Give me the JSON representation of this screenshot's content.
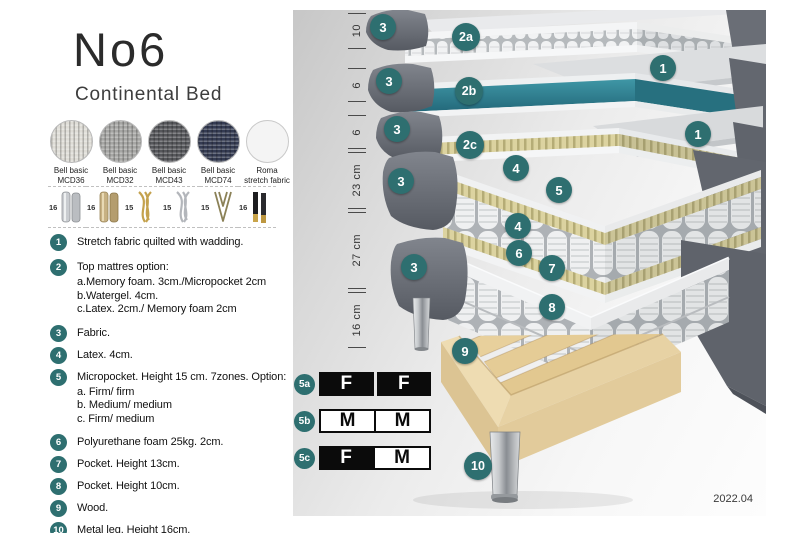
{
  "header": {
    "title": "No6",
    "subtitle": "Continental Bed"
  },
  "fabric_swatches": [
    {
      "name": "Bell basic",
      "code": "MCD36",
      "color": "#dedcd6"
    },
    {
      "name": "Bell basic",
      "code": "MCD32",
      "color": "#a6a6a4"
    },
    {
      "name": "Bell basic",
      "code": "MCD43",
      "color": "#56575b"
    },
    {
      "name": "Bell basic",
      "code": "MCD74",
      "color": "#343b52"
    },
    {
      "name": "Roma",
      "code": "stretch fabric",
      "color": "#f4f4f4"
    }
  ],
  "legs": [
    {
      "height": "16",
      "type": "cylinder-silver"
    },
    {
      "height": "16",
      "type": "cylinder-brass"
    },
    {
      "height": "15",
      "type": "twisted-gold"
    },
    {
      "height": "15",
      "type": "twisted-silver"
    },
    {
      "height": "15",
      "type": "hairpin"
    },
    {
      "height": "16",
      "type": "straight-black-brass"
    }
  ],
  "legend": {
    "items": [
      {
        "num": "1",
        "text": "Stretch fabric quilted with wadding."
      },
      {
        "num": "2",
        "text": "Top mattres option:",
        "subs": [
          "a.Memory foam. 3cm./Micropocket 2cm",
          "b.Watergel. 4cm.",
          "c.Latex. 2cm./ Memory foam 2cm"
        ]
      },
      {
        "num": "3",
        "text": "Fabric."
      },
      {
        "num": "4",
        "text": "Latex. 4cm."
      },
      {
        "num": "5",
        "text": "Micropocket. Height 15 cm. 7zones. Option:",
        "subs": [
          "a. Firm/ firm",
          "b. Medium/ medium",
          "c. Firm/ medium"
        ]
      },
      {
        "num": "6",
        "text": "Polyurethane foam 25kg. 2cm."
      },
      {
        "num": "7",
        "text": "Pocket. Height 13cm."
      },
      {
        "num": "8",
        "text": "Pocket. Height 10cm."
      },
      {
        "num": "9",
        "text": "Wood."
      },
      {
        "num": "10",
        "text": "Metal leg. Height 16cm."
      }
    ]
  },
  "diagram": {
    "measurements": [
      {
        "label": "10"
      },
      {
        "label": "6"
      },
      {
        "label": "6"
      },
      {
        "label": "23 cm"
      },
      {
        "label": "27 cm"
      },
      {
        "label": "16 cm"
      }
    ],
    "badges": [
      {
        "label": "3"
      },
      {
        "label": "2a"
      },
      {
        "label": "1"
      },
      {
        "label": "3"
      },
      {
        "label": "2b"
      },
      {
        "label": "1"
      },
      {
        "label": "3"
      },
      {
        "label": "2c"
      },
      {
        "label": "3"
      },
      {
        "label": "4"
      },
      {
        "label": "5"
      },
      {
        "label": "4"
      },
      {
        "label": "3"
      },
      {
        "label": "6"
      },
      {
        "label": "7"
      },
      {
        "label": "8"
      },
      {
        "label": "9"
      },
      {
        "label": "10"
      }
    ],
    "firmness_table": {
      "rows": [
        {
          "id": "5a",
          "cells": [
            {
              "text": "F",
              "filled": true
            },
            {
              "text": "F",
              "filled": true
            }
          ]
        },
        {
          "id": "5b",
          "cells": [
            {
              "text": "M",
              "filled": false
            },
            {
              "text": "M",
              "filled": false
            }
          ]
        },
        {
          "id": "5c",
          "cells": [
            {
              "text": "F",
              "filled": true
            },
            {
              "text": "M",
              "filled": false
            }
          ]
        }
      ]
    }
  },
  "colors": {
    "badge_teal": "#2e6f70",
    "watergel_teal": "#2f7f90",
    "table_black": "#0b0b0b",
    "fabric_gray": "#62666e"
  },
  "footer": {
    "version_label": "2022.04"
  }
}
